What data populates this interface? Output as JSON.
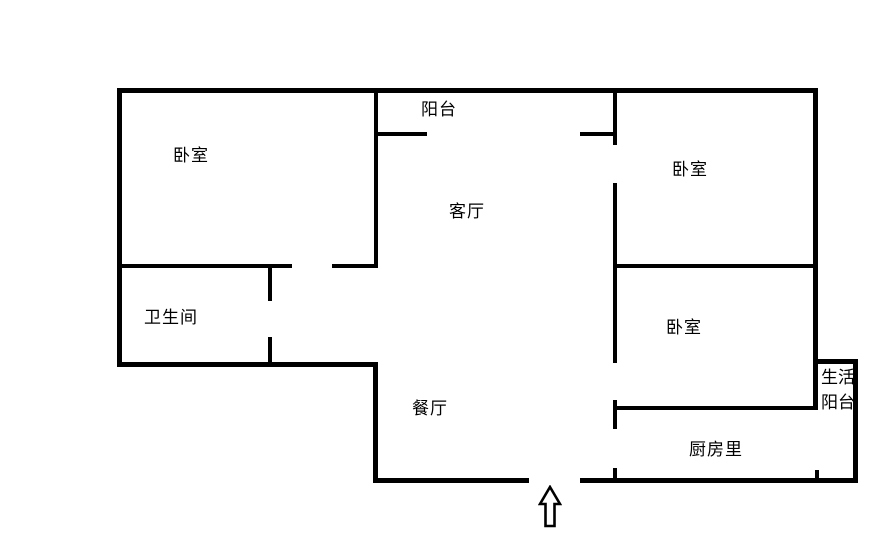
{
  "floorplan": {
    "background_color": "#ffffff",
    "wall_color": "#000000",
    "rooms": {
      "balcony": {
        "label": "阳台"
      },
      "bedroom_top_left": {
        "label": "卧室"
      },
      "bedroom_top_right": {
        "label": "卧室"
      },
      "living_room": {
        "label": "客厅"
      },
      "bathroom": {
        "label": "卫生间"
      },
      "bedroom_mid_right": {
        "label": "卧室"
      },
      "utility_balcony": {
        "label_line1": "生活",
        "label_line2": "阳台"
      },
      "dining_room": {
        "label": "餐厅"
      },
      "kitchen": {
        "label": "厨房里"
      }
    },
    "icons": {
      "entrance_arrow": "hollow-up-arrow"
    }
  }
}
